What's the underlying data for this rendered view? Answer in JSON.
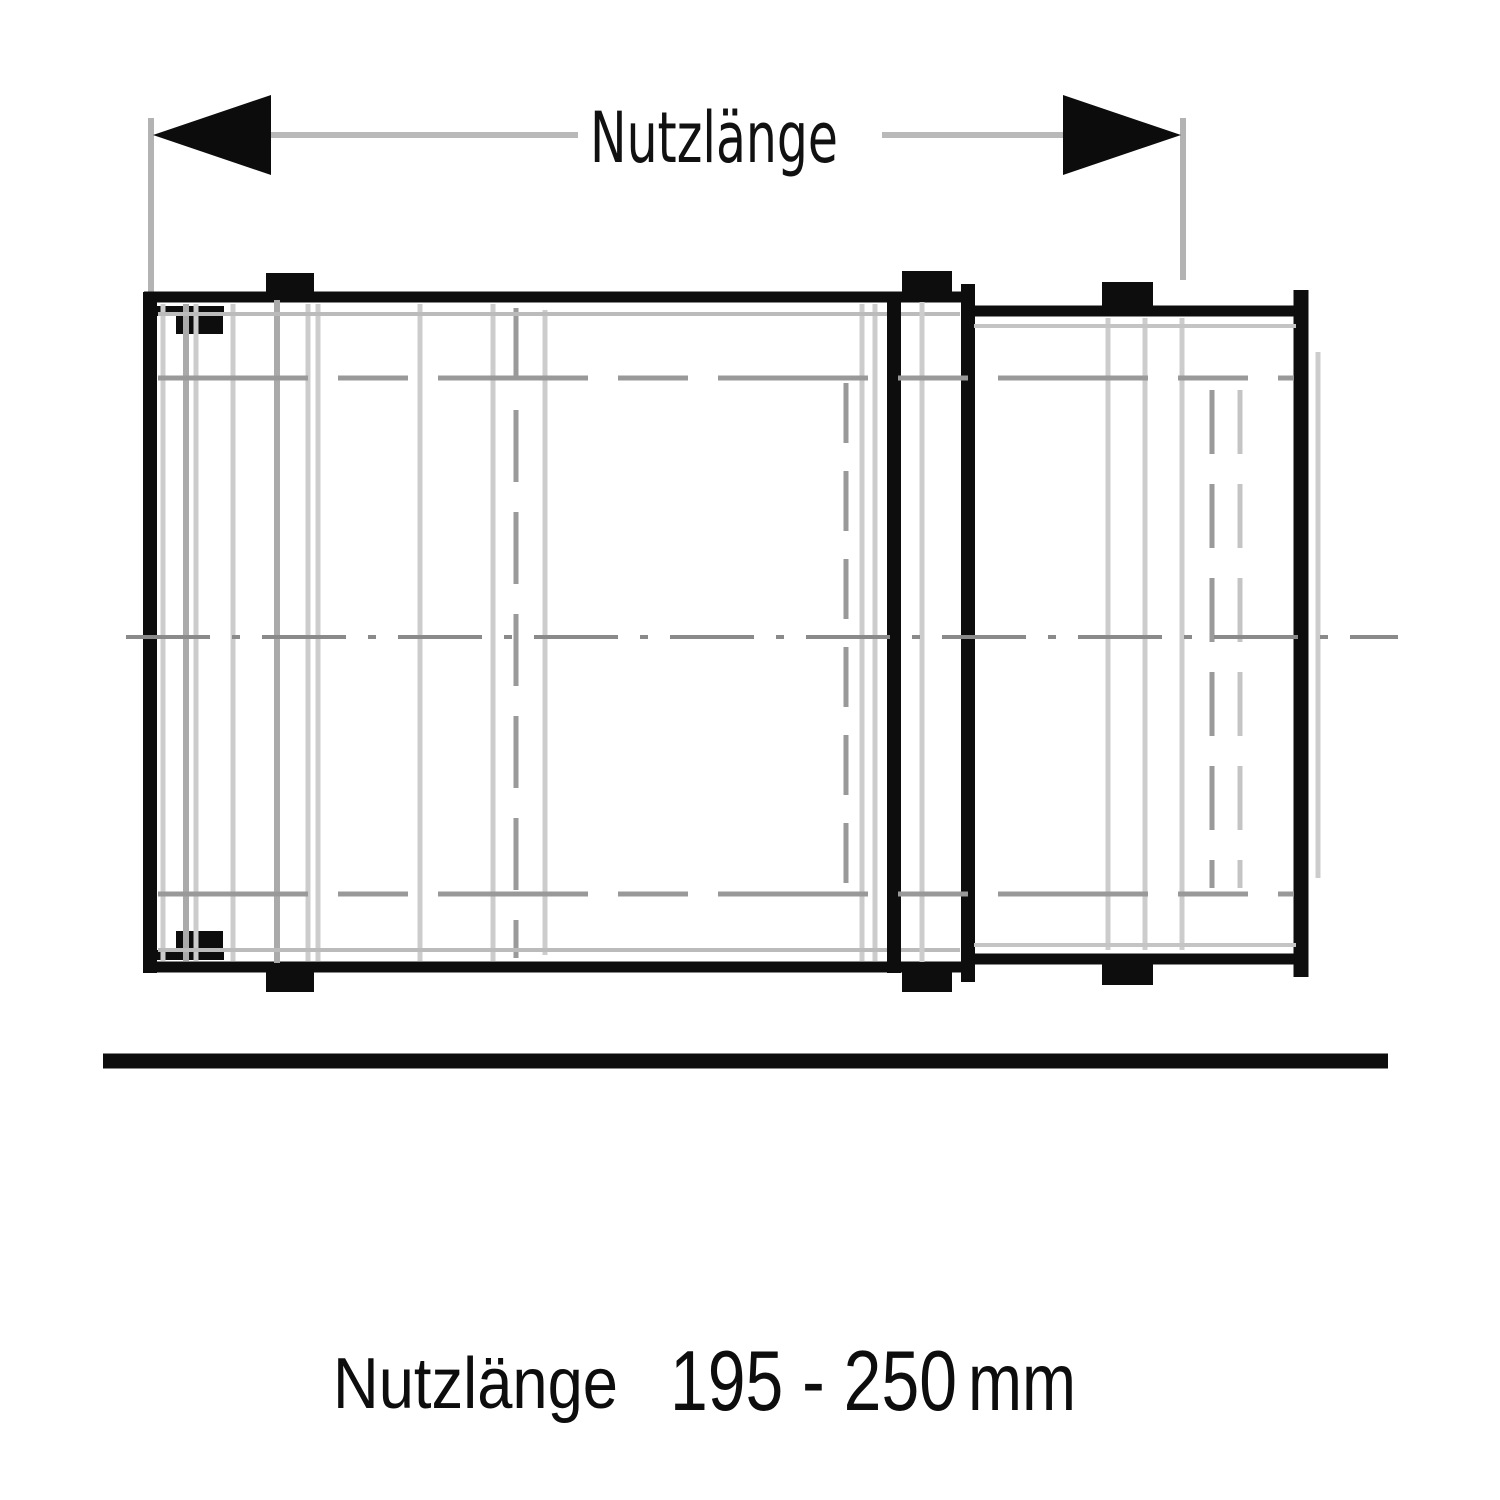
{
  "diagram": {
    "type": "technical-drawing",
    "subject": "telescopic-flue-pipe-length-element",
    "dimension": {
      "label": "Nutzlänge"
    },
    "caption": {
      "label": "Nutzlänge",
      "value": "195 - 250",
      "unit": "mm"
    },
    "colors": {
      "ink": "#0d0d0d",
      "dimension_line": "#b9b9b9",
      "hidden_line": "#999999",
      "detail_line": "#cccccc",
      "centerline": "#8a8a8a",
      "background": "#ffffff"
    }
  }
}
